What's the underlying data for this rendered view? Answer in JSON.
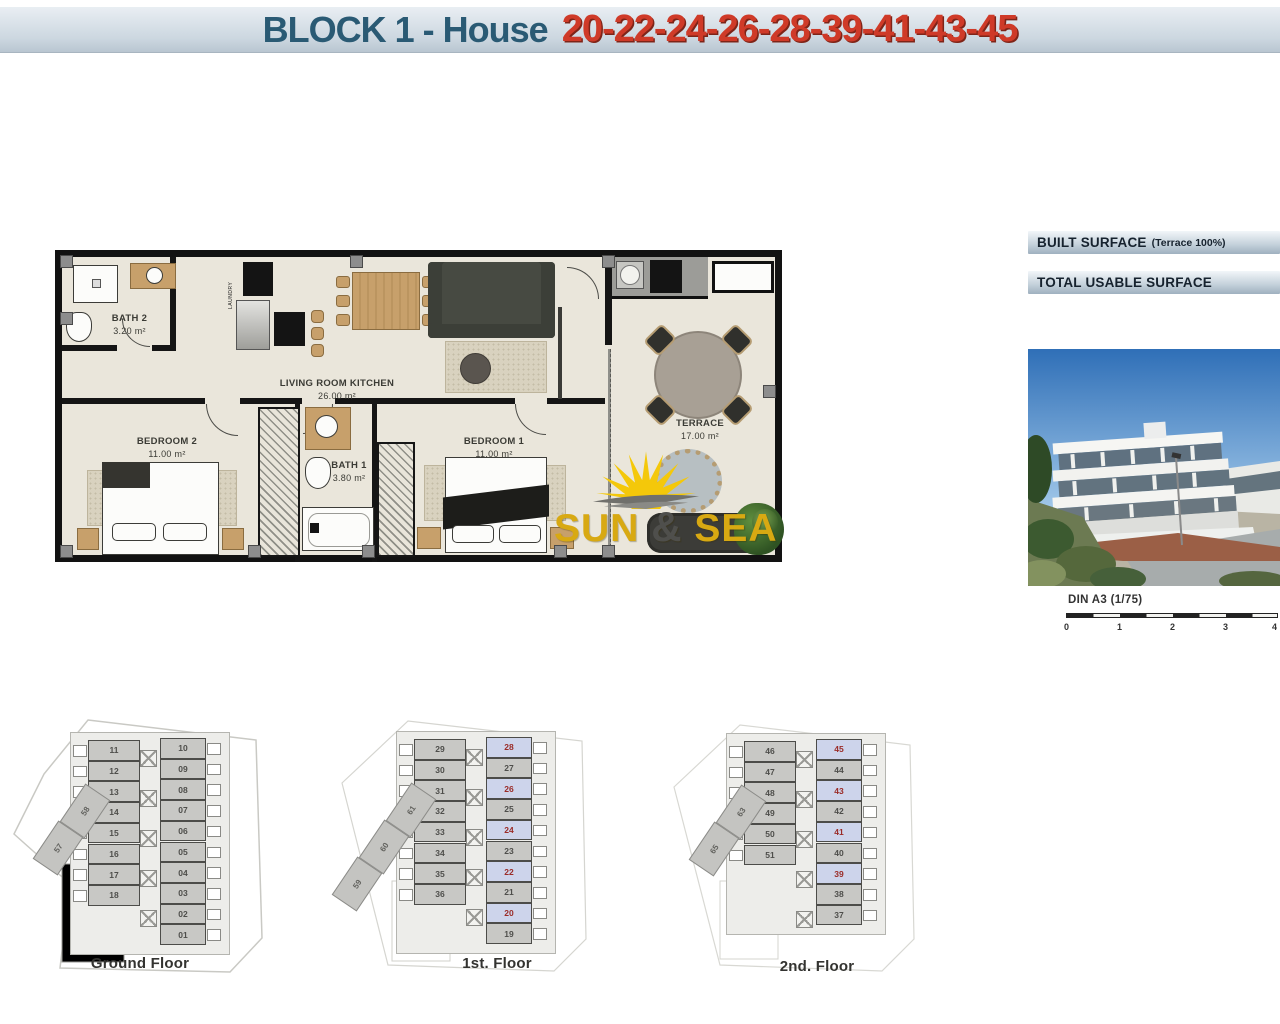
{
  "header": {
    "title_block": "BLOCK 1 - House",
    "title_numbers": "20-22-24-26-28-39-41-43-45"
  },
  "surface_panel": {
    "built_label": "BUILT SURFACE",
    "built_note": "(Terrace 100%)",
    "usable_label": "TOTAL USABLE SURFACE"
  },
  "floor_plan": {
    "rooms": [
      {
        "name": "BATH 2",
        "area": "3.20 m²"
      },
      {
        "name": "LIVING ROOM KITCHEN",
        "area": "26.00 m²"
      },
      {
        "name": "BEDROOM 2",
        "area": "11.00 m²"
      },
      {
        "name": "BATH 1",
        "area": "3.80 m²"
      },
      {
        "name": "BEDROOM 1",
        "area": "11.00 m²"
      },
      {
        "name": "TERRACE",
        "area": "17.00 m²"
      }
    ],
    "laundry_label": "LAUNDRY"
  },
  "watermark": {
    "sun": "SUN",
    "amp": "&",
    "sea": "SEA"
  },
  "scale_bar": {
    "label": "DIN A3 (1/75)",
    "ticks": [
      "0",
      "1",
      "2",
      "3",
      "4"
    ]
  },
  "mini_plans": [
    {
      "label": "Ground Floor",
      "left_units": [
        "11",
        "12",
        "13",
        "14",
        "15",
        "16",
        "17",
        "18"
      ],
      "right_units": [
        {
          "n": "10",
          "hl": false
        },
        {
          "n": "09",
          "hl": false
        },
        {
          "n": "08",
          "hl": false
        },
        {
          "n": "07",
          "hl": false
        },
        {
          "n": "06",
          "hl": false
        },
        {
          "n": "05",
          "hl": false
        },
        {
          "n": "04",
          "hl": false
        },
        {
          "n": "03",
          "hl": false
        },
        {
          "n": "02",
          "hl": false
        },
        {
          "n": "01",
          "hl": false
        }
      ],
      "diagonal_units": [
        "58",
        "57"
      ]
    },
    {
      "label": "1st. Floor",
      "left_units": [
        "29",
        "30",
        "31",
        "32",
        "33",
        "34",
        "35",
        "36"
      ],
      "right_units": [
        {
          "n": "28",
          "hl": true
        },
        {
          "n": "27",
          "hl": false
        },
        {
          "n": "26",
          "hl": true
        },
        {
          "n": "25",
          "hl": false
        },
        {
          "n": "24",
          "hl": true
        },
        {
          "n": "23",
          "hl": false
        },
        {
          "n": "22",
          "hl": true
        },
        {
          "n": "21",
          "hl": false
        },
        {
          "n": "20",
          "hl": true
        },
        {
          "n": "19",
          "hl": false
        }
      ],
      "diagonal_units": [
        "61",
        "60",
        "59"
      ]
    },
    {
      "label": "2nd. Floor",
      "left_units": [
        "46",
        "47",
        "48",
        "49",
        "50",
        "51"
      ],
      "right_units": [
        {
          "n": "45",
          "hl": true
        },
        {
          "n": "44",
          "hl": false
        },
        {
          "n": "43",
          "hl": true
        },
        {
          "n": "42",
          "hl": false
        },
        {
          "n": "41",
          "hl": true
        },
        {
          "n": "40",
          "hl": false
        },
        {
          "n": "39",
          "hl": true
        },
        {
          "n": "38",
          "hl": false
        },
        {
          "n": "37",
          "hl": false
        }
      ],
      "diagonal_units": [
        "63",
        "65"
      ]
    }
  ],
  "colors": {
    "title_blue": "#2a5a74",
    "title_red": "#cf3a28",
    "highlight_unit_bg": "#cdd4eb",
    "highlight_unit_num": "#9a2b27",
    "unit_bg": "#c8c8c5",
    "plan_bg": "#eae6db",
    "watermark_gold": "#d8a912",
    "header_bar": "#ccd7e0"
  }
}
